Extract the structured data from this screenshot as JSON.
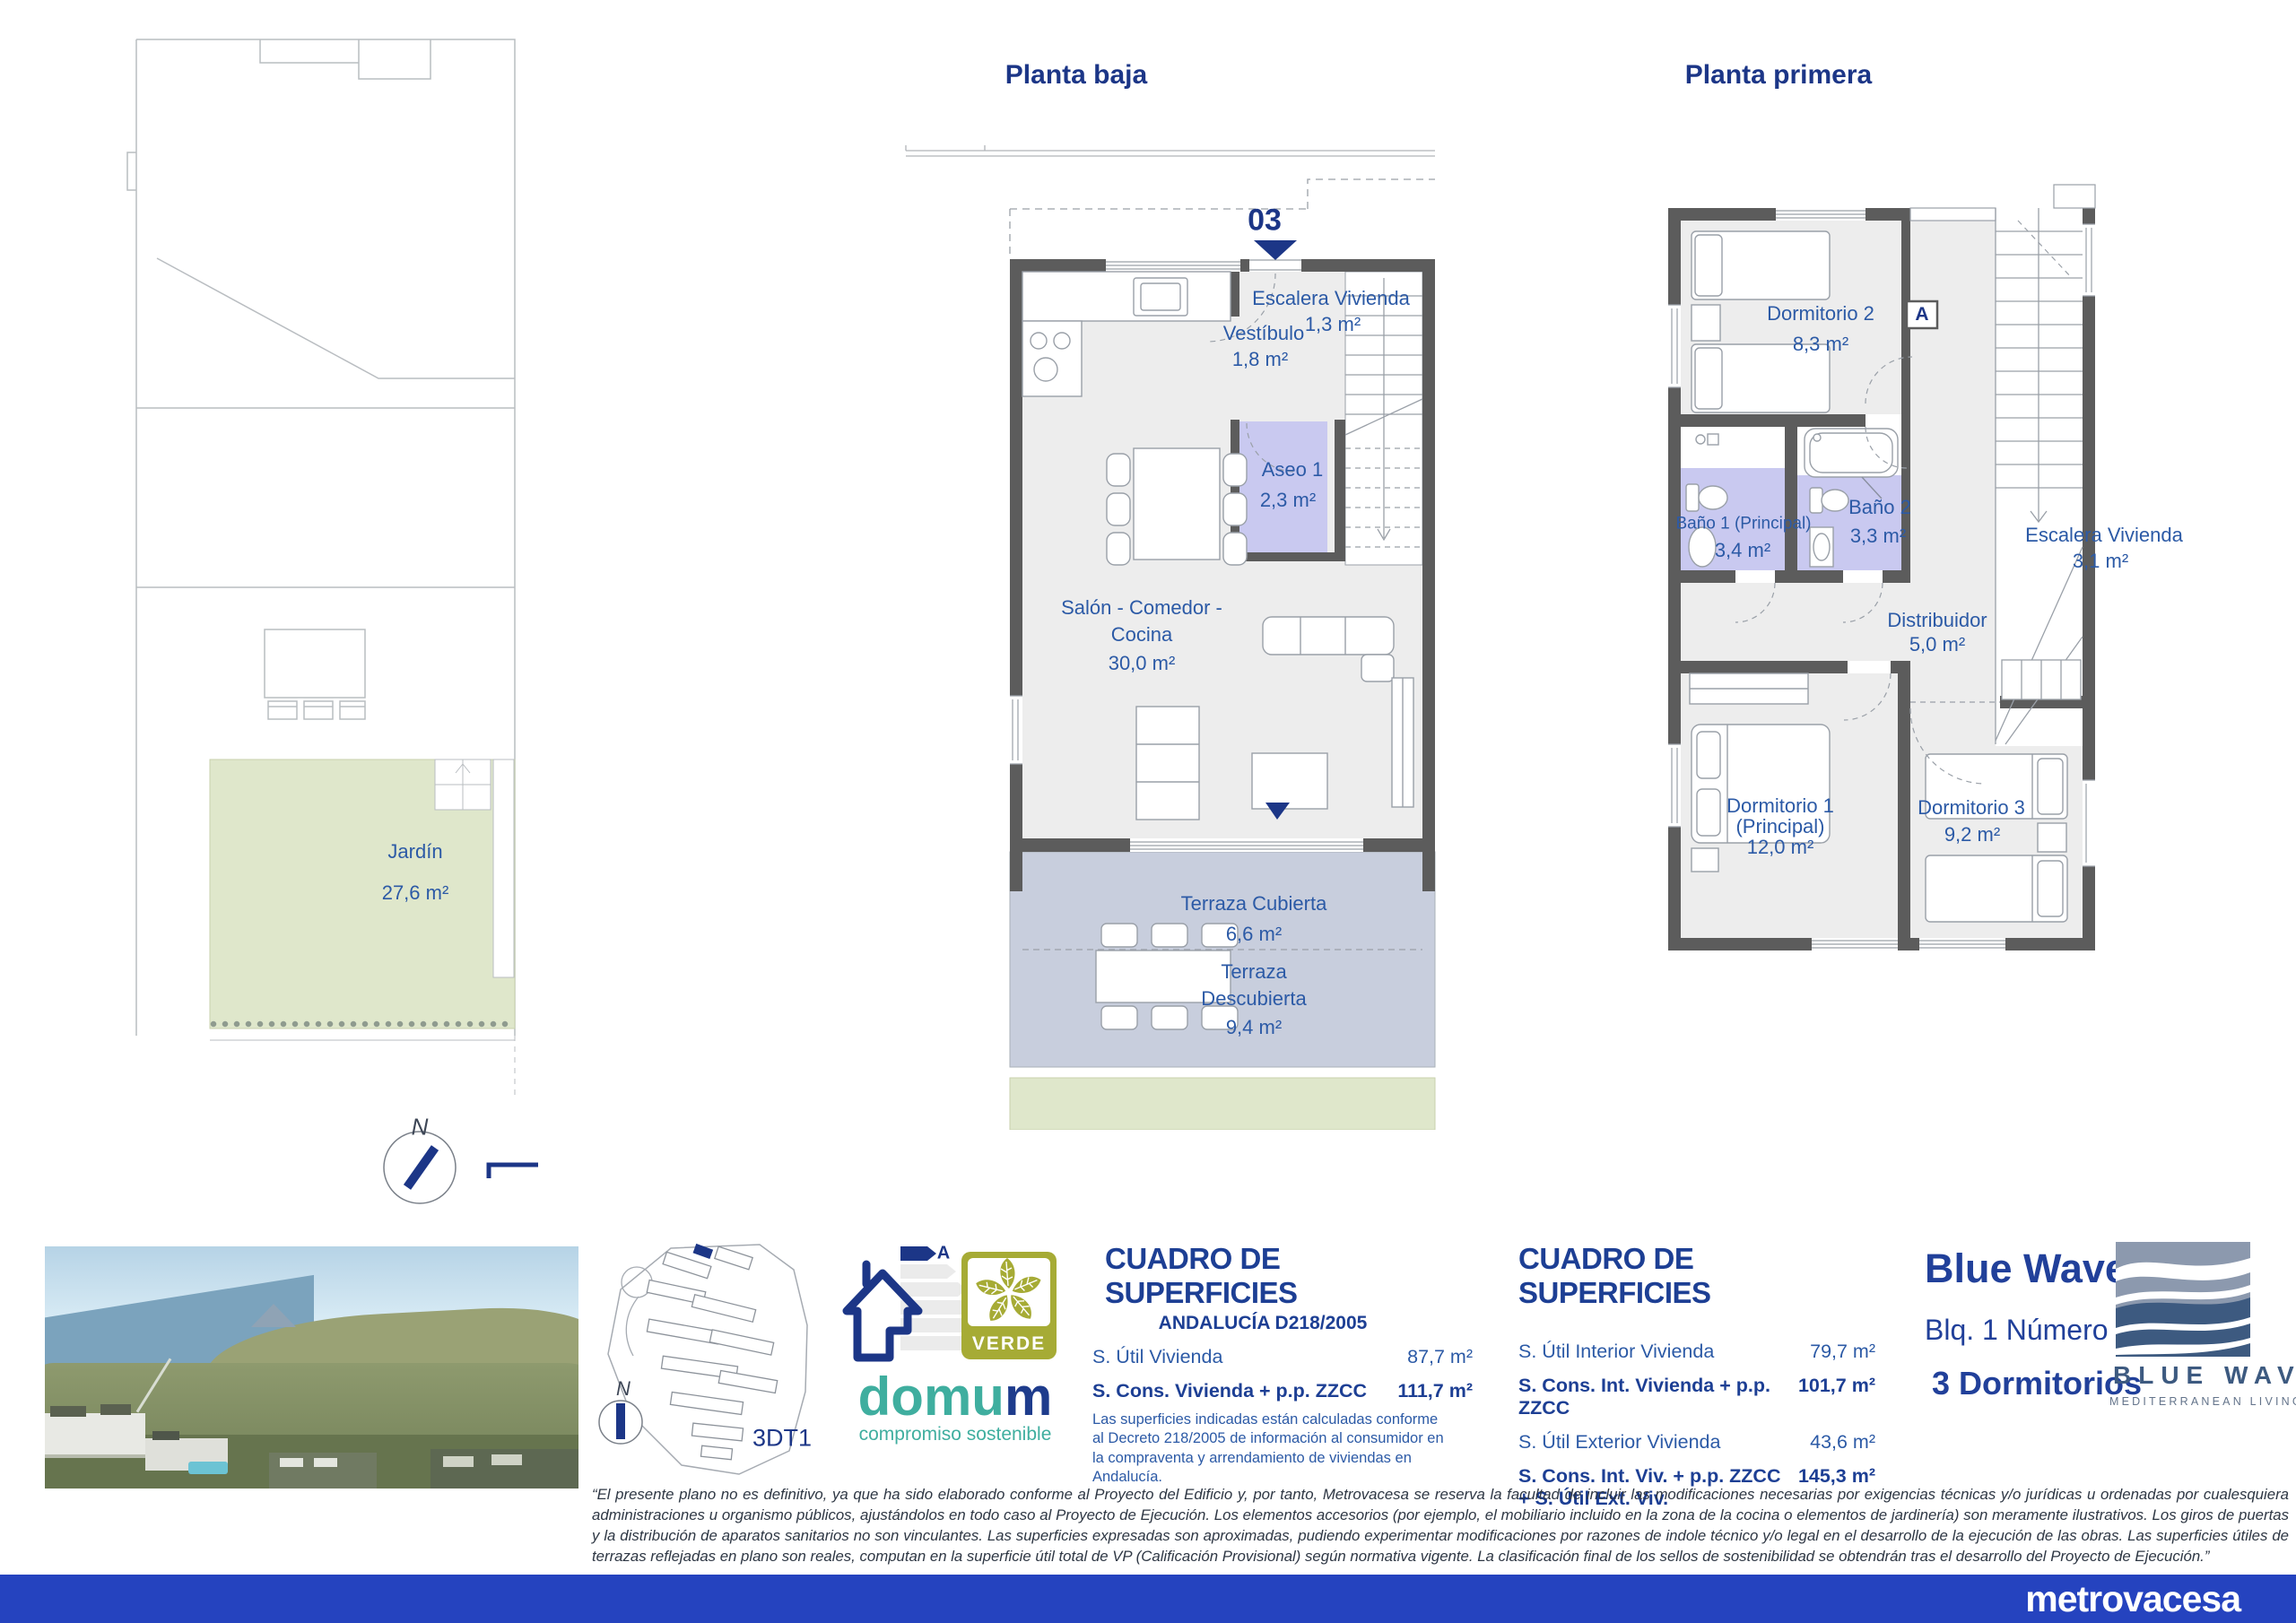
{
  "ground_floor": {
    "title": "Planta baja",
    "unit_number": "03",
    "rooms": {
      "escalera": {
        "name": "Escalera Vivienda",
        "area": "1,3 m²"
      },
      "vestibulo": {
        "name": "Vestíbulo",
        "area": "1,8 m²"
      },
      "aseo": {
        "name": "Aseo 1",
        "area": "2,3 m²"
      },
      "salon": {
        "name_line1": "Salón - Comedor -",
        "name_line2": "Cocina",
        "area": "30,0 m²"
      },
      "terraza_cubierta": {
        "name": "Terraza Cubierta",
        "area": "6,6 m²"
      },
      "terraza_descubierta": {
        "name_line1": "Terraza",
        "name_line2": "Descubierta",
        "area": "9,4 m²"
      }
    }
  },
  "first_floor": {
    "title": "Planta primera",
    "section_marker": "A",
    "rooms": {
      "dormitorio2": {
        "name": "Dormitorio 2",
        "area": "8,3 m²"
      },
      "bano1": {
        "name": "Baño 1 (Principal)",
        "area": "3,4 m²"
      },
      "bano2": {
        "name": "Baño 2",
        "area": "3,3 m²"
      },
      "escalera": {
        "name": "Escalera Vivienda",
        "area": "3,1 m²"
      },
      "distribuidor": {
        "name": "Distribuidor",
        "area": "5,0 m²"
      },
      "dormitorio1": {
        "name_line1": "Dormitorio 1",
        "name_line2": "(Principal)",
        "area": "12,0 m²"
      },
      "dormitorio3": {
        "name": "Dormitorio 3",
        "area": "9,2 m²"
      }
    }
  },
  "site_plan": {
    "garden": {
      "name": "Jardín",
      "area": "27,6 m²"
    },
    "north_label": "N"
  },
  "location_map": {
    "north_label": "N",
    "plan_code": "3DT1"
  },
  "certifications": {
    "energy_rating": "A",
    "verde_label": "VERDE",
    "domum_name_part1": "domu",
    "domum_name_part2": "m",
    "domum_tagline": "compromiso sostenible"
  },
  "surface_table_d218": {
    "title": "CUADRO DE SUPERFICIES",
    "subtitle": "ANDALUCÍA D218/2005",
    "rows": [
      {
        "label": "S. Útil Vivienda",
        "value": "87,7 m²"
      },
      {
        "label": "S. Cons. Vivienda + p.p. ZZCC",
        "value": "111,7 m²"
      }
    ],
    "note": "Las superficies indicadas están calculadas conforme al Decreto 218/2005 de información al consumidor en la compraventa y arrendamiento de viviendas en Andalucía."
  },
  "surface_table_general": {
    "title": "CUADRO DE SUPERFICIES",
    "rows": [
      {
        "label": "S. Útil Interior Vivienda",
        "value": "79,7 m²"
      },
      {
        "label": "S. Cons. Int. Vivienda + p.p. ZZCC",
        "value": "101,7 m²"
      },
      {
        "label": "S. Útil Exterior Vivienda",
        "value": "43,6 m²"
      },
      {
        "label": "S. Cons. Int. Viv. + p.p. ZZCC + S. Útil Ext. Viv.",
        "value": "145,3 m²"
      }
    ]
  },
  "unit_info": {
    "development": "Blue Wave",
    "block": "Blq. 1 Número 03",
    "bedrooms": "3 Dormitorios"
  },
  "brand": {
    "logo_title": "BLUE WAVE",
    "logo_subtitle": "MEDITERRANEAN LIVING",
    "footer_logo": "metrovacesa"
  },
  "disclaimer": "“El presente plano no es definitivo, ya que ha sido elaborado conforme al Proyecto del Edificio y, por tanto, Metrovacesa se reserva la facultad de incluir las modificaciones necesarias por exigencias técnicas y/o jurídicas u ordenadas por cualesquiera administraciones u organismo públicos, ajustándolos en todo caso al Proyecto de Ejecución. Los elementos accesorios (por ejemplo, el mobiliario incluido en la zona de la cocina o elementos de jardinería) son meramente ilustrativos. Los giros de puertas y la distribución de aparatos sanitarios no son vinculantes. Las superficies expresadas son aproximadas, pudiendo experimentar modificaciones por razones de indole técnico y/o legal en el desarrollo de la ejecución de las obras. Las superficies útiles de terrazas reflejadas en plano son reales, computan en la superficie útil total de VP (Calificación Provisional) según normativa vigente. La clasificación final de los sellos de sostenibilidad se obtendrán tras el desarrollo del Proyecto de Ejecución.”",
  "colors": {
    "navy": "#1c3687",
    "label_blue": "#2c5aa6",
    "footer_bar": "#2543bf",
    "terrace_fill": "#c8cedd",
    "garden_fill": "#dfe7cb",
    "bathroom_fill": "#c9c9f0",
    "wall_gray": "#5c5c5c",
    "verde_olive": "#a6ab35",
    "domum_teal": "#3fae9f",
    "wave_navy": "#3d5a80",
    "wave_gray": "#8c99ae"
  }
}
